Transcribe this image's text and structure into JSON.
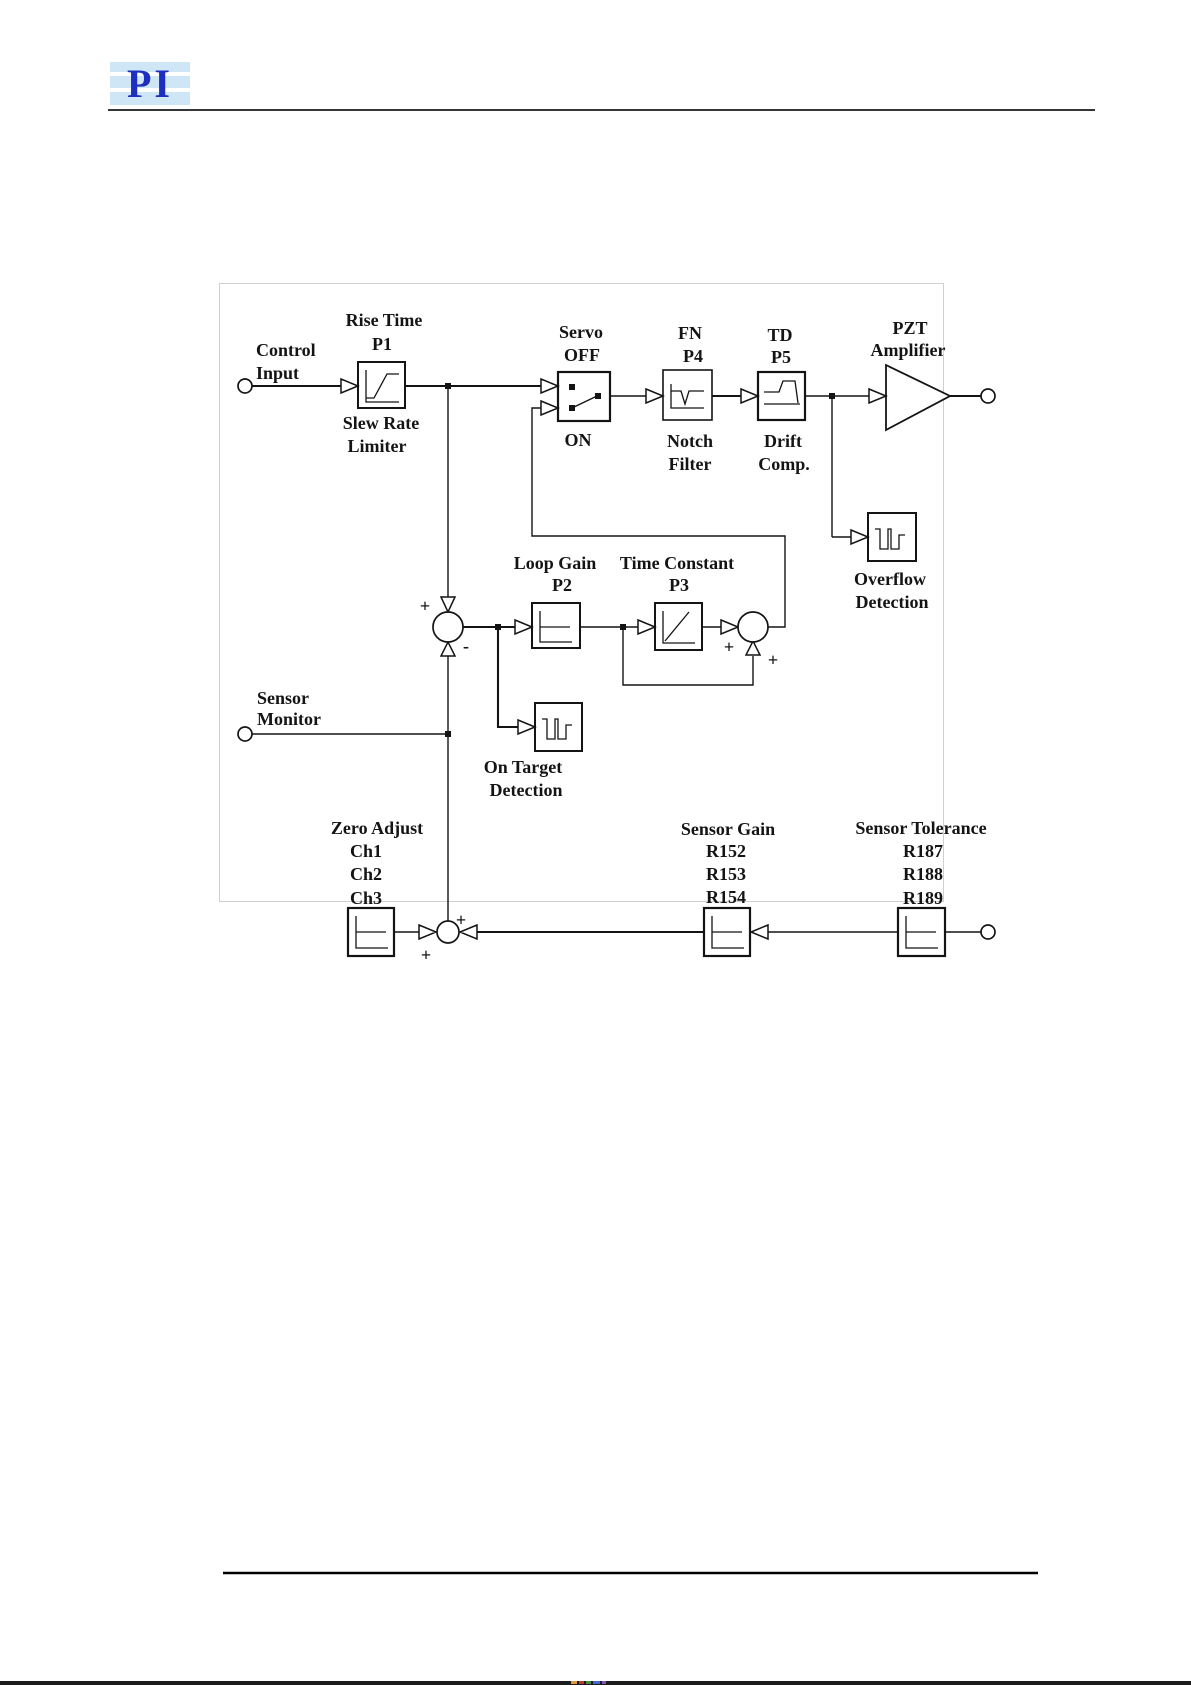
{
  "page": {
    "logo_text": "PI",
    "colors": {
      "logo_blue": "#1c2fc0",
      "logo_background": "#cfe6f7",
      "diagram_line": "#141414",
      "faint_border": "#cfcfcf"
    }
  },
  "diagram": {
    "labels": {
      "control": {
        "l1": "Control",
        "l2": "Input"
      },
      "rise_time": {
        "l1": "Rise Time",
        "l2": "P1"
      },
      "slew_rate": {
        "l1": "Slew Rate",
        "l2": "Limiter"
      },
      "servo": {
        "l1": "Servo",
        "l2": "OFF",
        "on": "ON"
      },
      "notch": {
        "l1": "FN",
        "l2": "P4",
        "b1": "Notch",
        "b2": "Filter"
      },
      "drift": {
        "l1": "TD",
        "l2": "P5",
        "b1": "Drift",
        "b2": "Comp."
      },
      "pzt": {
        "l1": "PZT",
        "l2": "Amplifier"
      },
      "overflow": {
        "l1": "Overflow",
        "l2": "Detection"
      },
      "loop_gain": {
        "l1": "Loop Gain",
        "l2": "P2"
      },
      "time_constant": {
        "l1": "Time Constant",
        "l2": "P3"
      },
      "on_target": {
        "l1": "On Target",
        "l2": "Detection"
      },
      "sensor_monitor": {
        "l1": "Sensor",
        "l2": "Monitor"
      },
      "zero_adjust": {
        "l1": "Zero Adjust",
        "ch": [
          "Ch1",
          "Ch2",
          "Ch3"
        ]
      },
      "sensor_gain": {
        "l1": "Sensor Gain",
        "r": [
          "R152",
          "R153",
          "R154"
        ]
      },
      "sensor_tolerance": {
        "l1": "Sensor Tolerance",
        "r": [
          "R187",
          "R188",
          "R189"
        ]
      }
    },
    "signs": {
      "plus": "+",
      "minus": "-"
    }
  }
}
